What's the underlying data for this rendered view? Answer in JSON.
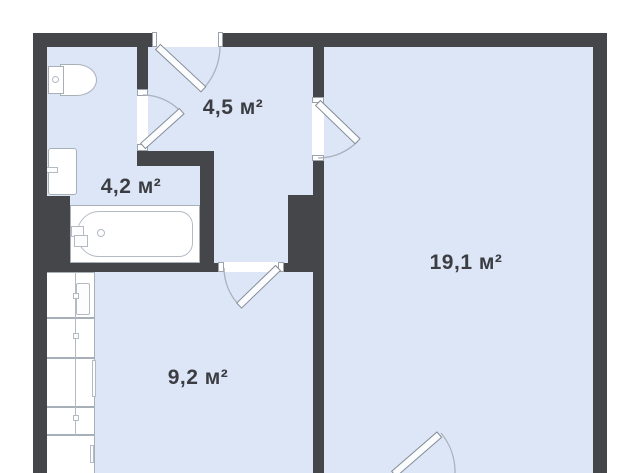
{
  "plan": {
    "type": "apartment-floor-plan",
    "colors": {
      "wall": "#45464a",
      "floor": "#dce6f7",
      "background": "#ffffff",
      "label": "#3b3d42"
    },
    "rooms": [
      {
        "id": "hallway",
        "label": "4,5 м²"
      },
      {
        "id": "bathroom",
        "label": "4,2 м²"
      },
      {
        "id": "kitchen",
        "label": "9,2 м²"
      },
      {
        "id": "living-room",
        "label": "19,1 м²"
      }
    ],
    "fixtures": [
      {
        "id": "toilet"
      },
      {
        "id": "washbasin"
      },
      {
        "id": "bathtub"
      },
      {
        "id": "kitchen-counter"
      }
    ],
    "doors": [
      {
        "id": "entrance-door"
      },
      {
        "id": "bathroom-door"
      },
      {
        "id": "living-room-door"
      },
      {
        "id": "kitchen-door"
      },
      {
        "id": "balcony-door"
      }
    ]
  }
}
